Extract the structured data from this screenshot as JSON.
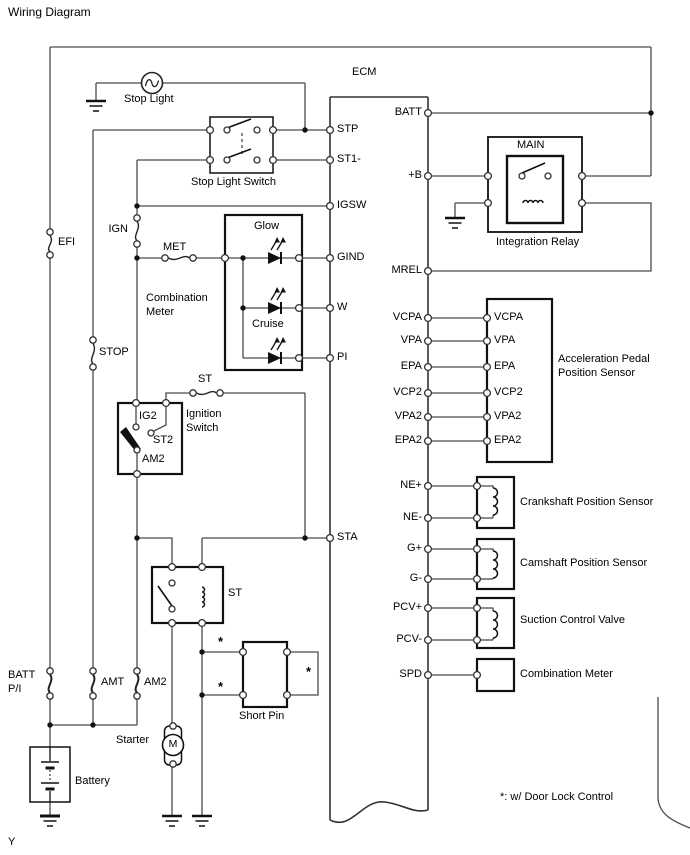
{
  "title": "Wiring Diagram",
  "page_marker": "Y",
  "footnote": "*: w/ Door Lock Control",
  "asterisk": "*",
  "ecm": {
    "label": "ECM",
    "left": {
      "stp": "STP",
      "st1": "ST1-",
      "igsw": "IGSW",
      "gind": "GIND",
      "w": "W",
      "pi": "PI",
      "sta": "STA"
    },
    "right": {
      "batt": "BATT",
      "plus_b": "+B",
      "mrel": "MREL",
      "vcpa": "VCPA",
      "vpa": "VPA",
      "epa": "EPA",
      "vcp2": "VCP2",
      "vpa2": "VPA2",
      "epa2": "EPA2",
      "ne_plus": "NE+",
      "ne_minus": "NE-",
      "g_plus": "G+",
      "g_minus": "G-",
      "pcv_plus": "PCV+",
      "pcv_minus": "PCV-",
      "spd": "SPD"
    }
  },
  "fuses": {
    "efi": "EFI",
    "stop": "STOP",
    "ign": "IGN",
    "met": "MET",
    "st": "ST",
    "batt_pi": "BATT\nP/I",
    "amt": "AMT",
    "am2": "AM2"
  },
  "stop_light": {
    "label": "Stop Light"
  },
  "stop_light_switch": {
    "label": "Stop Light Switch"
  },
  "integration_relay": {
    "label": "Integration Relay",
    "main": "MAIN"
  },
  "combination_meter": {
    "label": "Combination\nMeter",
    "glow": "Glow",
    "cruise": "Cruise"
  },
  "ignition_switch": {
    "label": "Ignition\nSwitch",
    "ig2": "IG2",
    "st2": "ST2",
    "am2": "AM2"
  },
  "st_relay": {
    "label": "ST"
  },
  "short_pin": {
    "label": "Short Pin"
  },
  "starter": {
    "label": "Starter",
    "motor": "M"
  },
  "battery": {
    "label": "Battery"
  },
  "sensors": {
    "app": {
      "name": "Acceleration Pedal\nPosition Sensor",
      "pins": {
        "vcpa": "VCPA",
        "vpa": "VPA",
        "epa": "EPA",
        "vcp2": "VCP2",
        "vpa2": "VPA2",
        "epa2": "EPA2"
      }
    },
    "crank": "Crankshaft Position Sensor",
    "cam": "Camshaft Position Sensor",
    "scv": "Suction Control Valve",
    "spd_meter": "Combination Meter"
  }
}
